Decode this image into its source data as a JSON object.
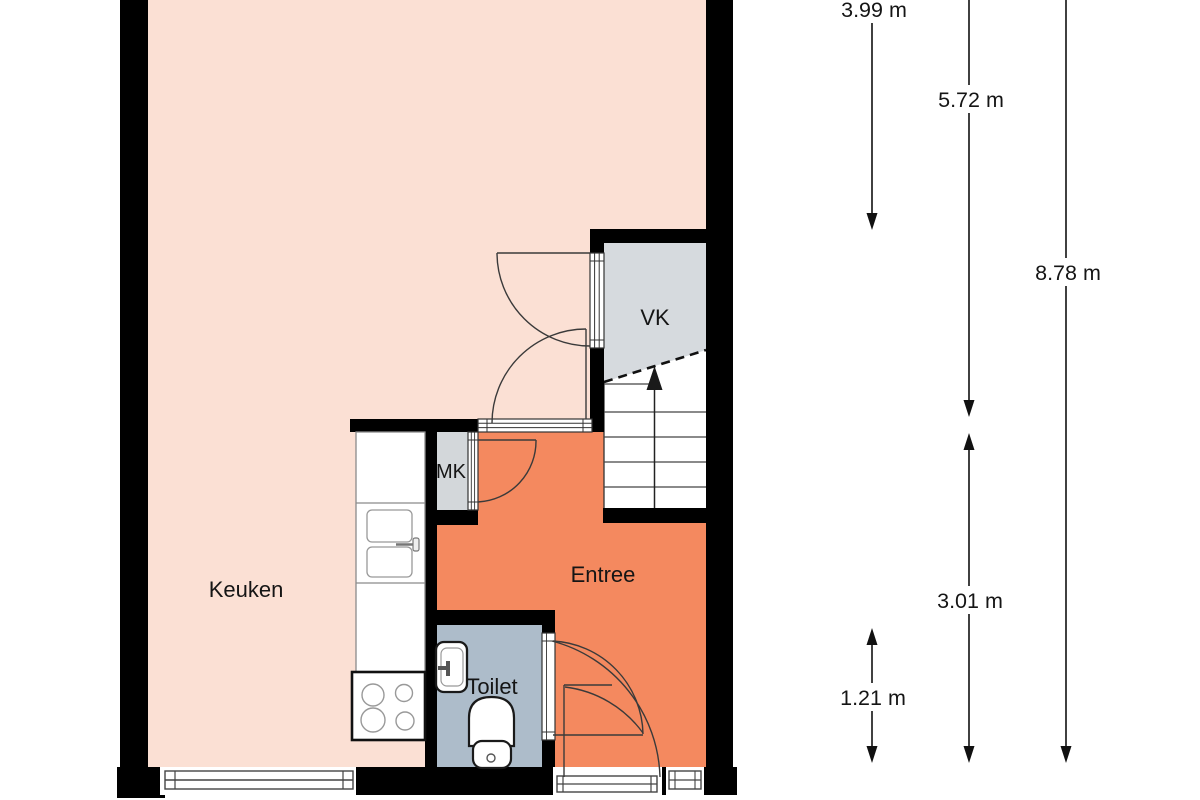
{
  "plan": {
    "type": "floorplan",
    "rooms": {
      "keuken": {
        "label": "Keuken"
      },
      "entree": {
        "label": "Entree"
      },
      "toilet": {
        "label": "Toilet"
      },
      "vk": {
        "label": "VK"
      },
      "mk": {
        "label": "MK"
      }
    },
    "dimensions": {
      "d1": {
        "label": "3.99 m"
      },
      "d2": {
        "label": "5.72 m"
      },
      "d3": {
        "label": "8.78 m"
      },
      "d4": {
        "label": "3.01 m"
      },
      "d5": {
        "label": "1.21 m"
      }
    },
    "features": [
      "stairs-up-arrow",
      "kitchen-counter",
      "sink-double",
      "stove-4-burners",
      "toilet-wc",
      "toilet-washbasin",
      "door-swings",
      "windows"
    ],
    "colors": {
      "keuken_floor": "#fbe0d4",
      "entree_floor": "#f4895f",
      "toilet_floor": "#adbcca",
      "vk_floor": "#d6dade",
      "mk_floor": "#d3d7da",
      "wall": "#000000",
      "outline": "#3a3a3a"
    }
  }
}
